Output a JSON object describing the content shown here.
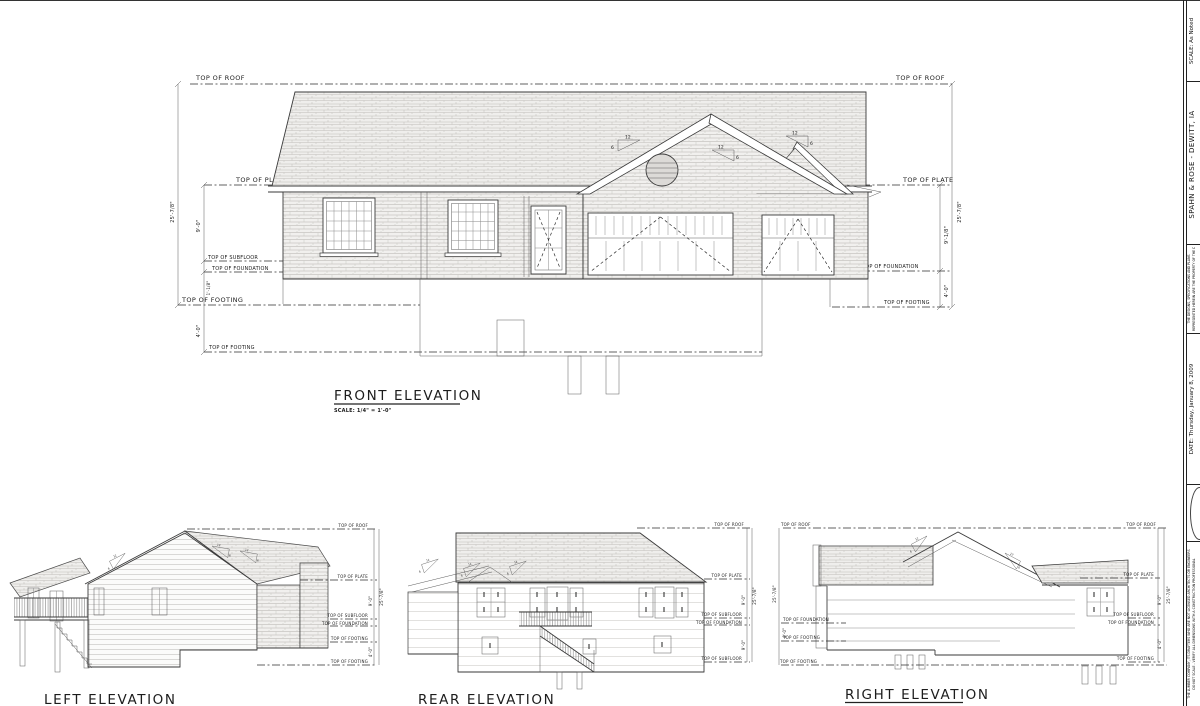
{
  "sheet": {
    "levels": {
      "roof": "TOP OF ROOF",
      "plate": "TOP OF PLATE",
      "subfloor": "TOP OF SUBFLOOR",
      "foundation": "TOP OF FOUNDATION",
      "footing": "TOP OF FOOTING"
    },
    "dims": {
      "overall": "25'-7/8\"",
      "main_floor": "9'-0\"",
      "subfloor_to_foundation": "1'-1/8\"",
      "plate_to_foundation": "9'-1/8\"",
      "foundation_to_footing": "4'-0\"",
      "basement": "9'-0\""
    },
    "pitch": {
      "run": "12",
      "rise": "6"
    },
    "front": {
      "title": "FRONT ELEVATION",
      "scale": "SCALE: 1/4\" = 1'-0\""
    },
    "left": {
      "title": "LEFT ELEVATION"
    },
    "rear": {
      "title": "REAR ELEVATION"
    },
    "right": {
      "title": "RIGHT ELEVATION"
    }
  },
  "title_block": {
    "scale_note": "SCALE: As Noted",
    "project": "SPAHN & ROSE - DEWITT, IA",
    "notice_top_1": "THE DESIGNS, SPECIFICATIONS AND PLANS",
    "notice_top_2": "REPRESENTED HEREIN ARE THE PROPERTY OF THE DESIGNER",
    "date": "DATE: Thursday, January 8, 2009",
    "notice_bottom_1": "THE LUMBER COMPANY, ITS DRAFTERS WHO ARE NOT LICENSED ARCHITECTS OR ENGINEERS",
    "notice_bottom_2": "DO NOT SCALE - VERIFY ALL DIMENSIONS WITH A CONSTRUCTION PROFESSIONAL"
  },
  "colors": {
    "paper": "#ffffff",
    "line": "#3a3a3a",
    "hatch": "#c4c2be"
  }
}
